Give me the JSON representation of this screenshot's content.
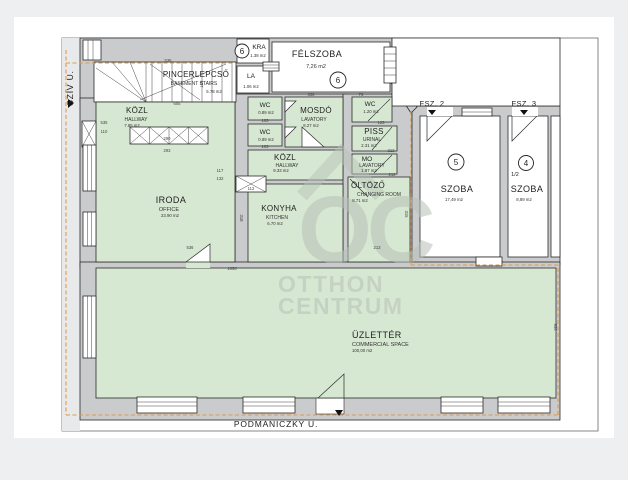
{
  "colors": {
    "room_green": "#d7e8d2",
    "wall_gray": "#cacbcd",
    "boundary_orange": "#e09a4a",
    "watermark_gray": "#b7c1b8",
    "page_gray": "#edeff1"
  },
  "streets": {
    "left": "SZÍV U.",
    "bottom": "PODMANICZKY U."
  },
  "entrances": {
    "fsz2": "FSZ. 2",
    "fsz3": "FSZ. 3"
  },
  "watermark": {
    "logo": "OC",
    "line1": "OTTHON",
    "line2": "CENTRUM"
  },
  "rooms": {
    "pincerlepcso": {
      "name": "PINCERLEPCSŐ",
      "sub": "BASEMENT STAIRS",
      "area": "5.78 m2"
    },
    "kra": {
      "name": "KRA",
      "area": "1.38 m2"
    },
    "la": {
      "name": "LA",
      "area": "1.06 m2"
    },
    "felszoba": {
      "name": "FÉLSZOBA",
      "area": "7,26 m2",
      "number": "6"
    },
    "unit6": {
      "number": "6"
    },
    "kozl1": {
      "name": "KÖZL",
      "sub": "HALLWAY",
      "area": "7.85 m2"
    },
    "wc1": {
      "name": "WC",
      "area": "0.89 m2"
    },
    "wc2": {
      "name": "WC",
      "area": "0.89 m2"
    },
    "mosdo": {
      "name": "MOSDÓ",
      "sub": "LAVATORY",
      "area": "8.27 m2"
    },
    "wc3": {
      "name": "WC",
      "area": "1.20 m2"
    },
    "piss": {
      "name": "PISS",
      "sub": "URINAL",
      "area": "2.31 m2"
    },
    "mo": {
      "name": "MO",
      "sub": "LAVATORY",
      "area": "1.97 m2"
    },
    "kozl2": {
      "name": "KÖZL",
      "sub": "HALLWAY",
      "area": "9.33 m2"
    },
    "konyha": {
      "name": "KONYHA",
      "sub": "KITCHEN",
      "area": "6.70 m2"
    },
    "iroda": {
      "name": "IRODA",
      "sub": "OFFICE",
      "area": "23.90 m2"
    },
    "oltozo": {
      "name": "ÖLTÖZŐ",
      "sub": "CHANGING ROOM",
      "area": "8.71 m2"
    },
    "szoba5": {
      "name": "SZOBA",
      "area": "17,49 m2",
      "number": "5"
    },
    "szoba4": {
      "name": "SZOBA",
      "area": "8,89 m2",
      "number": "4",
      "half": "1/2"
    },
    "uzletter": {
      "name": "ÜZLETTÉR",
      "sub": "COMMERCIAL SPACE",
      "area": "100,00 m2"
    }
  },
  "dimensions": [
    {
      "t": "536",
      "x": 168,
      "y": 62
    },
    {
      "t": "605",
      "x": 177,
      "y": 105
    },
    {
      "t": "937",
      "x": 200,
      "y": 84,
      "r": 90
    },
    {
      "t": "535",
      "x": 104,
      "y": 124
    },
    {
      "t": "110",
      "x": 104,
      "y": 133
    },
    {
      "t": "290",
      "x": 167,
      "y": 140
    },
    {
      "t": "293",
      "x": 167,
      "y": 152
    },
    {
      "t": "117",
      "x": 220,
      "y": 172
    },
    {
      "t": "132",
      "x": 220,
      "y": 180
    },
    {
      "t": "112",
      "x": 251,
      "y": 190
    },
    {
      "t": "318",
      "x": 240,
      "y": 218,
      "r": 90
    },
    {
      "t": "536",
      "x": 190,
      "y": 249
    },
    {
      "t": "103",
      "x": 265,
      "y": 122
    },
    {
      "t": "103",
      "x": 265,
      "y": 148
    },
    {
      "t": "336",
      "x": 311,
      "y": 96
    },
    {
      "t": "76",
      "x": 361,
      "y": 96
    },
    {
      "t": "123",
      "x": 381,
      "y": 124
    },
    {
      "t": "212",
      "x": 391,
      "y": 152
    },
    {
      "t": "212",
      "x": 392,
      "y": 176
    },
    {
      "t": "213",
      "x": 377,
      "y": 249
    },
    {
      "t": "315",
      "x": 405,
      "y": 214,
      "r": 90
    },
    {
      "t": "1858",
      "x": 232,
      "y": 270
    },
    {
      "t": "936",
      "x": 554,
      "y": 327,
      "r": 90
    }
  ]
}
